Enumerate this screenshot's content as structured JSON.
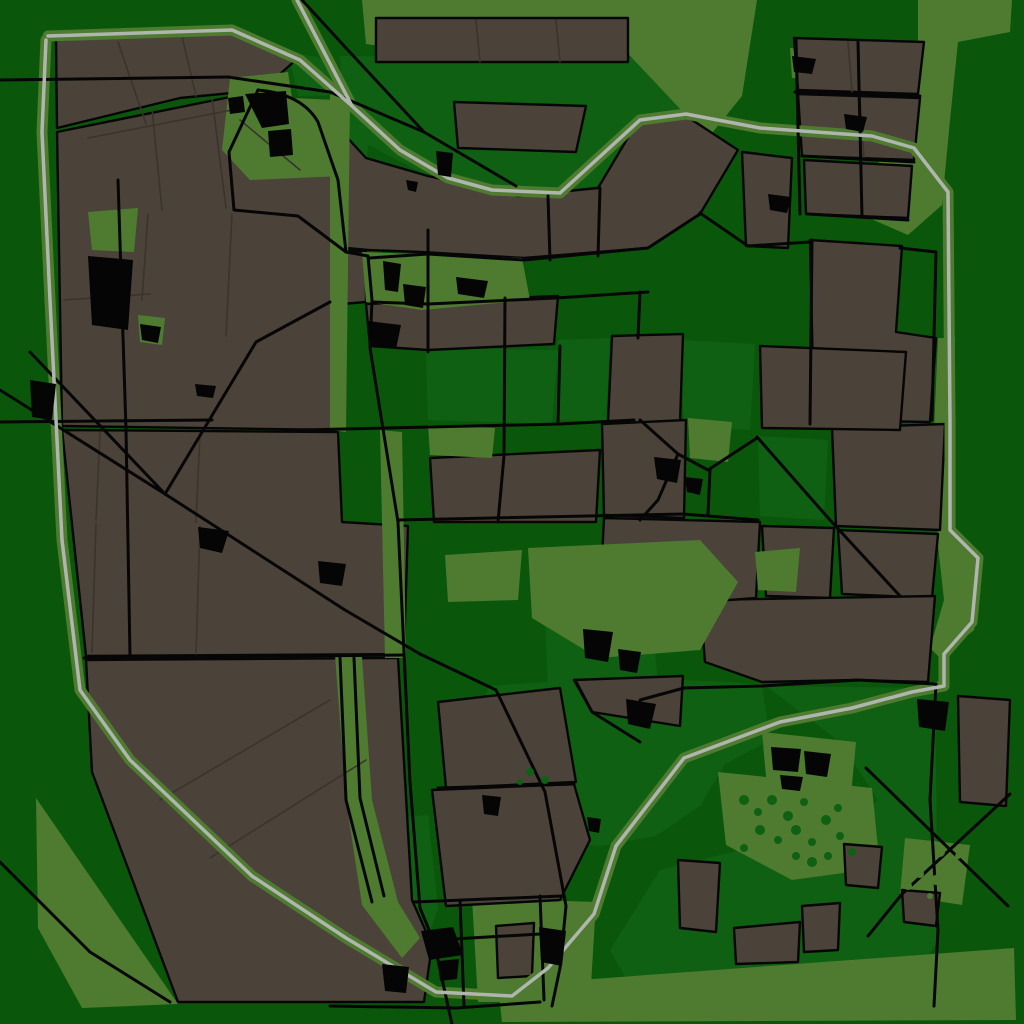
{
  "map": {
    "viewport": {
      "w": 1024,
      "h": 1024
    },
    "palette": {
      "bg": "#0A570B",
      "forest": "#0F6013",
      "meadow": "#4E7B2F",
      "field": "#4B433A",
      "field_line": "#3A342C",
      "black": "#060606",
      "gray": "#AFB6AF",
      "building": "#050505"
    },
    "layers": [
      {
        "name": "forest-patches",
        "kind": "shapes",
        "fill": "forest",
        "shapes": [
          "M340,56 L632,58 L683,112 L640,122 L598,186 L518,196 L430,177 L344,132 Z",
          "M288,52 L335,60 L338,95 L298,96 Z",
          "M342,128 L370,134 L362,188 L340,176 Z",
          "M426,348 L558,350 L552,424 L428,420 Z",
          "M558,340 L610,338 L606,422 L556,420 Z",
          "M300,428 L338,430 L334,525 L296,522 Z",
          "M488,686 L575,680 L592,712 L683,680 L762,684 L770,740 L725,764 L700,806 L656,836 L600,846 L548,842 L505,800 L480,740 Z",
          "M766,686 L935,688 L938,940 L900,1000 L640,1004 L610,950 L660,870 L740,850 L830,850 L878,800 L840,742 Z",
          "M680,340 L755,344 L750,430 L684,426 Z",
          "M758,436 L828,440 L824,520 L760,516 Z",
          "M545,612 L650,608 L658,682 L548,684 Z",
          "M342,822 L428,815 L438,908 L428,938 L396,940 L352,905 Z",
          "M140,205 L168,208 L164,232 L142,228 Z"
        ]
      },
      {
        "name": "meadows-under",
        "kind": "shapes",
        "fill": "meadow",
        "shapes": [
          "M362,0 L757,0 L742,96 L700,148 L683,112 L632,58 L600,22 L425,22 L422,52 L366,44 Z",
          "M918,0 L1012,0 L1010,32 L958,42 L950,120 L942,205 L908,235 L862,215 L872,170 L912,125 L918,60 Z",
          "M938,338 L955,338 L950,530 L982,558 L974,630 L940,658 L930,648 L944,600 L938,545 L934,430 Z",
          "M472,898 L596,902 L590,1002 L478,1002 Z",
          "M498,986 L1014,948 L1016,1020 L502,1022 Z",
          "M718,772 L872,788 L880,868 L792,880 L726,845 Z",
          "M762,732 L856,742 L850,806 L768,798 Z",
          "M36,798 L178,1004 L82,1008 L38,928 Z",
          "M905,838 L970,845 L962,905 L900,895 Z",
          "M790,48 L822,50 L818,80 L792,78 Z"
        ]
      },
      {
        "name": "fields",
        "kind": "shapes",
        "fill": "field",
        "stroke": "black",
        "stroke_width": 2.4,
        "shapes": [
          "M56,40 L238,31 L297,59 L262,90 L180,98 L57,128 Z",
          "M57,132 L235,96 L258,92 L298,150 L338,178 L344,250 L366,252 L366,302 L342,304 L338,430 L62,426 Z",
          "M62,430 L338,432 L342,522 L408,526 L404,654 L86,656 Z",
          "M86,660 L398,658 L412,900 L432,945 L424,1002 L178,1002 L92,772 Z",
          "M344,134 L366,158 L428,176 L518,196 L598,188 L636,124 L683,114 L738,150 L700,214 L648,248 L524,258 L420,252 L368,250 L346,248 Z",
          "M376,18 L628,18 L628,62 L376,62 Z",
          "M454,102 L586,106 L576,152 L458,148 Z",
          "M366,304 L558,296 L554,344 L428,350 L370,346 Z",
          "M612,336 L683,334 L680,424 L608,422 Z",
          "M430,458 L600,450 L596,522 L434,522 Z",
          "M602,424 L686,420 L684,518 L604,515 Z",
          "M832,428 L945,424 L940,530 L836,526 Z",
          "M838,530 L938,534 L932,598 L842,594 Z",
          "M762,526 L834,528 L830,598 L766,596 Z",
          "M700,600 L935,596 L928,682 L856,680 L762,682 L705,662 Z",
          "M604,518 L760,522 L756,598 L650,606 L600,598 Z",
          "M794,38 L924,42 L918,94 L798,90 Z",
          "M798,94 L920,98 L914,160 L802,156 Z",
          "M804,160 L912,166 L908,218 L806,214 Z",
          "M810,240 L902,246 L896,332 L936,338 L930,422 L814,420 Z",
          "M742,152 L792,158 L788,248 L746,246 Z",
          "M760,346 L906,352 L900,430 L762,428 Z",
          "M958,696 L1010,700 L1006,806 L960,802 Z",
          "M902,890 L940,893 L936,926 L904,922 Z",
          "M844,844 L882,847 L878,888 L846,885 Z",
          "M678,860 L720,863 L716,932 L680,928 Z",
          "M734,928 L800,922 L798,962 L736,964 Z",
          "M802,906 L840,903 L838,950 L804,952 Z",
          "M496,926 L534,923 L532,976 L498,978 Z",
          "M438,702 L560,688 L576,782 L446,788 Z",
          "M432,790 L574,784 L590,840 L560,900 L446,906 Z",
          "M574,680 L683,676 L680,726 L592,712 Z"
        ]
      },
      {
        "name": "meadows-over",
        "kind": "shapes",
        "fill": "meadow",
        "shapes": [
          "M88,212 L138,208 L134,252 L92,250 Z",
          "M138,315 L165,318 L162,345 L140,342 Z",
          "M362,252 L522,258 L530,300 L422,310 L366,302 Z",
          "M230,78 L288,72 L292,98 L336,100 L340,130 L342,176 L250,180 L222,150 Z",
          "M330,95 L350,98 L346,432 L330,430 Z",
          "M380,430 L402,432 L406,658 L385,658 Z",
          "M428,425 L495,428 L492,458 L430,455 Z",
          "M445,555 L522,550 L518,600 L448,602 Z",
          "M528,548 L700,540 L738,582 L700,650 L598,658 L532,618 Z",
          "M335,655 L362,657 L372,800 L398,902 L420,938 L402,958 L362,905 L346,800 Z",
          "M688,418 L732,422 L728,462 L690,458 Z",
          "M755,552 L800,548 L796,592 L758,590 Z"
        ]
      },
      {
        "name": "field-boundary-lines",
        "kind": "lines",
        "stroke": "field_line",
        "width": 1.6,
        "shapes": [
          "M118,42 L146,124",
          "M182,36 L196,96",
          "M88,138 L232,110",
          "M152,108 L162,210",
          "M212,98 L226,208",
          "M64,300 L150,294",
          "M148,214 L142,300",
          "M232,214 L226,336",
          "M100,432 L96,520",
          "M200,434 L196,522",
          "M96,524 L92,652",
          "M200,526 L196,654",
          "M160,800 L330,700",
          "M210,858 L366,760",
          "M240,120 L300,170",
          "M480,62 L476,20",
          "M560,62 L556,20",
          "M848,42 L852,92",
          "M860,98 L864,158"
        ]
      },
      {
        "name": "gray-road-fringe",
        "kind": "lines",
        "stroke": "meadow",
        "width": 11,
        "shapes": [
          "M48,36 L232,30 L300,60 L352,106 L400,150 L448,178 L492,190 L560,193 L640,120 L686,114 L760,128 L872,136 L914,148 L948,192 L950,420 L950,530 L978,558 L972,622 L944,654 L944,686 L912,692 L852,708 L780,722 L684,758 L616,846 L594,914 L548,968 L512,996 L436,992 L346,938 L252,876 L130,760 L80,690 L62,540 L50,300 L42,132 L46,40",
          "M297,0 L352,106"
        ]
      },
      {
        "name": "black-roads",
        "kind": "lines",
        "stroke": "black",
        "width": 3,
        "shapes": [
          "M0,80 L228,77",
          "M228,77 L330,92 L424,132 L516,186",
          "M302,0 L346,48 L424,132",
          "M258,90 Q302,94 318,122 L338,180 L346,252",
          "M346,252 L298,216 L234,210 L229,152 L258,90",
          "M346,252 L368,256 L372,300 L370,348 L398,522 L404,652 L410,782 L420,908 L434,942 L448,1006 L452,1024",
          "M30,352 L165,494 L345,610 L420,654",
          "M0,390 L165,494",
          "M165,494 L256,342 L330,302",
          "M0,422 L212,420",
          "M84,658 L404,655",
          "M370,258 L428,254 L524,260 L648,248 L700,214",
          "M372,302 L428,304 L556,298 L648,292",
          "M428,230 L428,352",
          "M548,196 L550,260",
          "M600,188 L598,256",
          "M505,298 L504,456 L498,522",
          "M560,346 L558,422",
          "M640,292 L638,338",
          "M300,430 L560,424 L634,420",
          "M398,520 L683,514 L758,520",
          "M420,654 L496,690 L545,792 L566,906 L560,968",
          "M414,902 L562,896",
          "M436,940 L540,934",
          "M460,900 L464,1006",
          "M540,896 L544,1000",
          "M640,700 L684,688 L762,686 L858,680 L936,684",
          "M936,684 L930,800 L938,930 L934,1006",
          "M866,768 L1008,906",
          "M1010,794 L902,894 L868,936",
          "M795,92 L920,96",
          "M802,156 L914,162",
          "M808,214 L908,220",
          "M858,42 L862,216",
          "M812,240 L810,424",
          "M900,248 L936,252 L932,420",
          "M757,437 L830,520 L900,596",
          "M640,420 L678,454 L708,470 L757,438",
          "M678,454 L658,500 L640,520",
          "M700,213 L748,246 L810,242",
          "M118,180 L126,430 L130,656",
          "M340,658 L346,800 L372,902",
          "M354,658 L360,798 L384,896",
          "M438,788 L574,784",
          "M330,1006 L456,1008 L540,1002",
          "M575,680 L592,712 L640,742",
          "M710,470 L708,514",
          "M560,968 L552,1006",
          "M796,40 L800,214",
          "M0,862 L90,952",
          "M90,952 L170,1002"
        ]
      },
      {
        "name": "gray-roads",
        "kind": "lines",
        "stroke": "gray",
        "width": 3.5,
        "shapes": [
          "M48,36 L232,30 L300,60 L352,106 L400,150 L448,178 L492,190 L560,193 L640,120 L686,114 L760,128 L872,136 L914,148 L948,192 L950,420 L950,530 L978,558 L972,622 L944,654 L944,686 L912,692 L852,708 L780,722 L684,758 L616,846 L594,914 L548,968 L512,996 L436,992 L346,938 L252,876 L130,760 L80,690 L62,540 L50,300 L42,132 L46,40",
          "M297,0 L352,106"
        ]
      },
      {
        "name": "buildings",
        "kind": "shapes",
        "fill": "building",
        "shapes": [
          "M245,94 L286,91 L289,124 L262,128 Z",
          "M268,131 L291,129 L293,155 L270,157 Z",
          "M228,98 L243,96 L245,112 L230,114 Z",
          "M88,256 L133,260 L128,330 L92,325 Z",
          "M140,324 L161,327 L158,343 L142,340 Z",
          "M30,380 L56,384 L52,420 L32,417 Z",
          "M195,384 L216,386 L213,398 L197,396 Z",
          "M383,261 L401,264 L398,292 L385,290 Z",
          "M403,284 L426,287 L423,308 L405,305 Z",
          "M456,277 L488,281 L484,298 L458,294 Z",
          "M368,321 L401,325 L396,349 L370,345 Z",
          "M436,151 L453,153 L451,177 L438,175 Z",
          "M583,629 L613,632 L608,662 L585,658 Z",
          "M618,649 L641,652 L637,673 L620,670 Z",
          "M626,699 L656,704 L650,729 L628,724 Z",
          "M318,561 L346,564 L342,586 L320,583 Z",
          "M198,527 L229,531 L222,553 L200,548 Z",
          "M654,457 L681,460 L677,483 L657,479 Z",
          "M685,477 L703,479 L700,495 L687,492 Z",
          "M792,56 L816,59 L812,74 L794,72 Z",
          "M844,114 L867,117 L863,132 L846,129 Z",
          "M768,194 L791,197 L787,213 L770,210 Z",
          "M917,699 L949,702 L945,731 L919,727 Z",
          "M771,747 L801,749 L798,772 L773,770 Z",
          "M804,751 L831,754 L827,777 L806,774 Z",
          "M780,775 L803,777 L800,791 L782,789 Z",
          "M421,931 L453,927 L463,955 L429,960 Z",
          "M438,961 L459,959 L457,979 L440,981 Z",
          "M539,927 L566,931 L562,966 L541,962 Z",
          "M382,964 L409,967 L406,993 L385,991 Z",
          "M482,795 L501,797 L498,816 L484,814 Z",
          "M587,817 L601,819 L599,833 L589,831 Z",
          "M406,180 L418,182 L416,192 L408,190 Z"
        ]
      },
      {
        "name": "tree-dots-dark",
        "kind": "dots",
        "fill": "forest",
        "shapes": [
          [
            744,
            800,
            5
          ],
          [
            758,
            812,
            4
          ],
          [
            772,
            800,
            5
          ],
          [
            788,
            816,
            5
          ],
          [
            804,
            802,
            4
          ],
          [
            760,
            830,
            5
          ],
          [
            778,
            840,
            4
          ],
          [
            796,
            830,
            5
          ],
          [
            812,
            842,
            4
          ],
          [
            744,
            848,
            4
          ],
          [
            826,
            820,
            5
          ],
          [
            840,
            836,
            4
          ],
          [
            828,
            856,
            4
          ],
          [
            812,
            862,
            5
          ],
          [
            796,
            856,
            4
          ],
          [
            530,
            772,
            4
          ],
          [
            545,
            780,
            4
          ],
          [
            520,
            782,
            3
          ],
          [
            838,
            808,
            4
          ],
          [
            852,
            852,
            4
          ]
        ]
      },
      {
        "name": "tree-dots-light",
        "kind": "dots",
        "fill": "meadow",
        "shapes": [
          [
            912,
            848,
            5
          ],
          [
            926,
            860,
            4
          ],
          [
            940,
            852,
            5
          ],
          [
            920,
            874,
            4
          ],
          [
            936,
            880,
            5
          ],
          [
            950,
            868,
            4
          ],
          [
            908,
            886,
            4
          ],
          [
            946,
            894,
            4
          ],
          [
            958,
            856,
            3
          ],
          [
            930,
            896,
            3
          ]
        ]
      }
    ]
  }
}
